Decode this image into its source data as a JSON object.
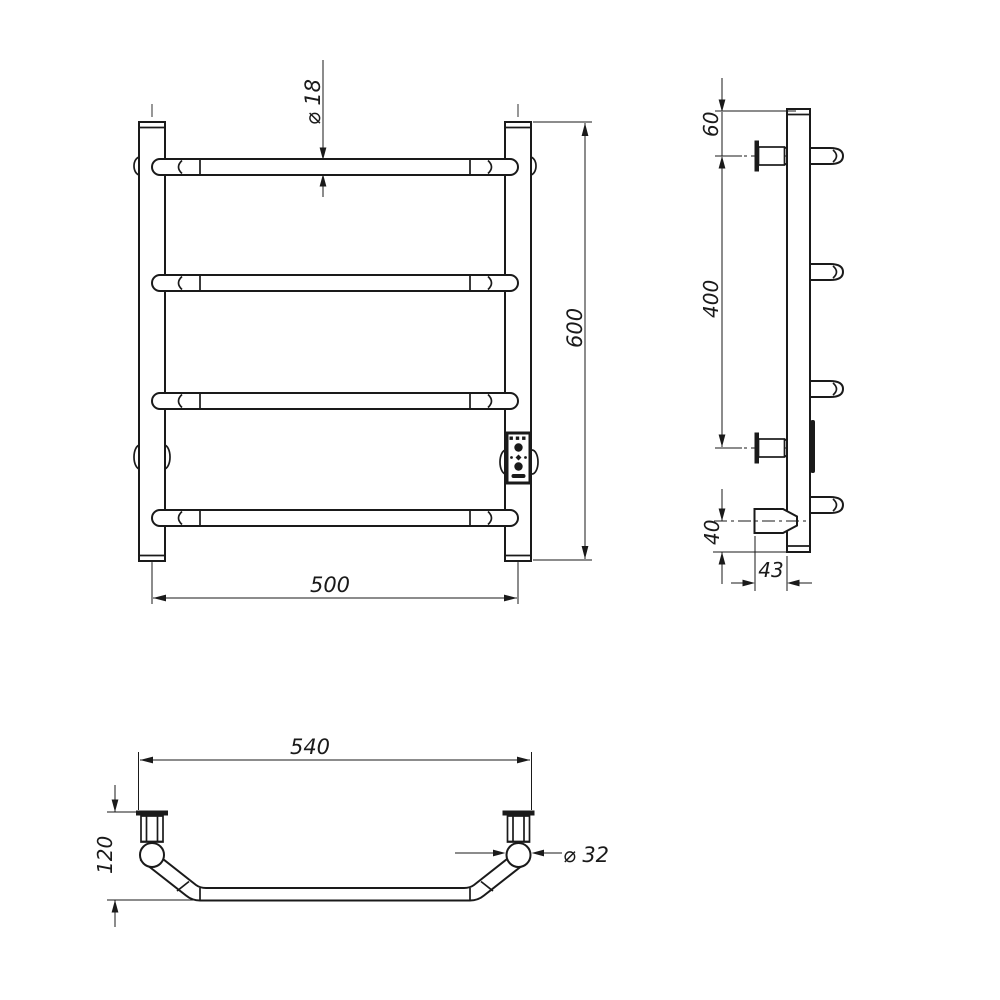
{
  "colors": {
    "background": "#ffffff",
    "line": "#1a1a1a"
  },
  "views": {
    "front": {
      "dims": {
        "bar_diameter": "⌀ 18",
        "overall_height": "600",
        "rail_width": "500"
      }
    },
    "side": {
      "dims": {
        "top_to_first_bar": "60",
        "bracket_spacing": "400",
        "bottom_offset": "40",
        "wall_to_post": "43"
      }
    },
    "top": {
      "dims": {
        "overall_width": "540",
        "depth": "120",
        "post_diameter": "⌀ 32"
      }
    }
  }
}
